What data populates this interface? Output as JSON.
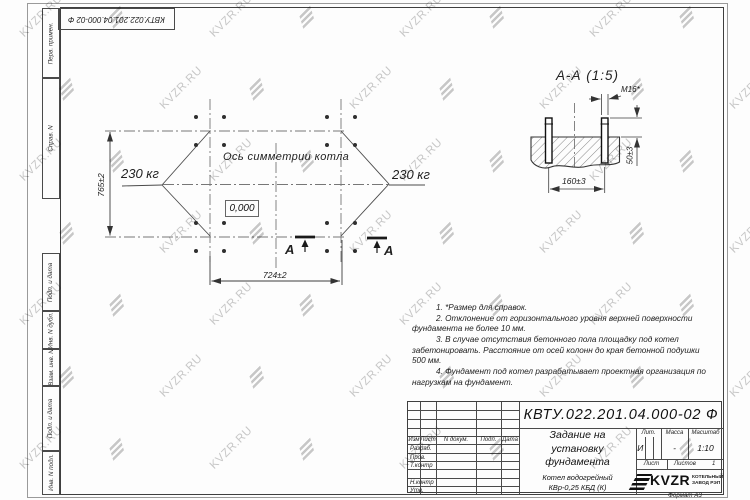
{
  "watermark": {
    "text": "KVZR.RU"
  },
  "frame": {
    "side_labels": [
      "Перв. примен.",
      "Справ. N",
      "Подп. и дата",
      "Инв. N дубл.",
      "Взам. инв. N",
      "Подп. и дата",
      "Инв. N подл."
    ]
  },
  "plan": {
    "axis_label": "Ось симметрии котла",
    "level_mark": "0,000",
    "load_left": "230 кг",
    "load_right": "230 кг",
    "dim_height": "765±2",
    "dim_width": "724±2",
    "section_letter": "А"
  },
  "section": {
    "title": "А-А (1:5)",
    "bolt_label": "М16*",
    "dim_spacing": "160±3",
    "dim_protrusion": "50±3"
  },
  "notes": [
    "1. *Размер для справок.",
    "2. Отклонение от горизонтального уровня верхней поверхности фундамента не более 10 мм.",
    "3. В случае отсутствия бетонного пола площадку под котел забетонировать. Расстояние от осей колонн до края бетонной подушки 500 мм.",
    "4. Фундамент под котел разрабатывает проектная организация по нагрузкам на фундамент."
  ],
  "titleblock": {
    "designation": "КВТУ.022.201.04.000-02 Ф",
    "doc_title": "Задание на\nустановку\nфундамента",
    "product": "Котел водогрейный\nКВр-0,25 КБД (К)",
    "header_cols": [
      "Изм",
      "Лист",
      "N докум.",
      "Подп.",
      "Дата"
    ],
    "row_labels": [
      "Разраб.",
      "Пров.",
      "Т.контр",
      "Н.контр",
      "Утв."
    ],
    "lit_label": "Лит.",
    "lit_value": "И",
    "mass_label": "Масса",
    "mass_value": "-",
    "scale_label": "Масштаб",
    "scale_value": "1:10",
    "sheet_label": "Лист",
    "sheets_label": "Листов",
    "sheets_value": "1",
    "logo_text": "KVZR",
    "logo_caption": "КОТЕЛЬНЫЙ\nЗАВОД РЭП",
    "format_label": "Формат А3"
  }
}
